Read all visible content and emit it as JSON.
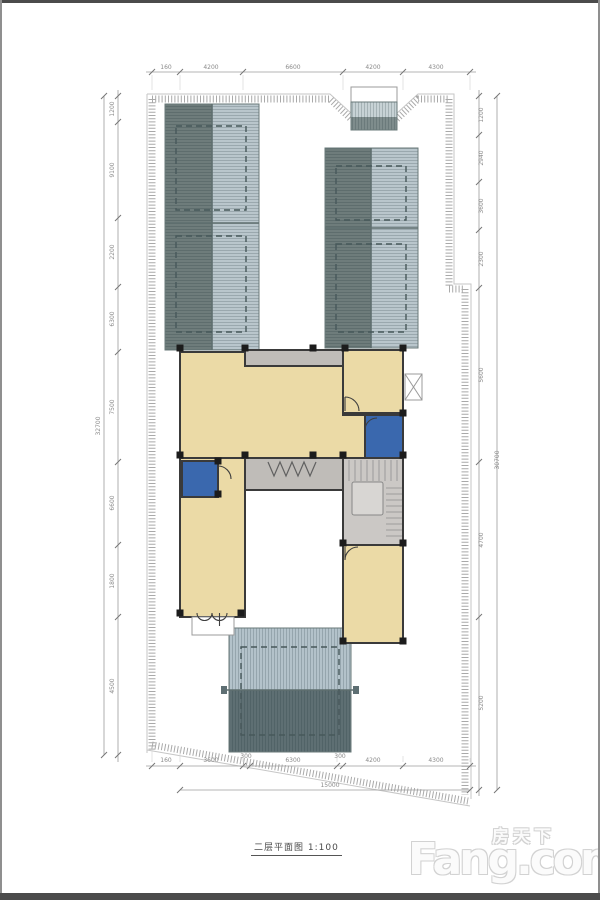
{
  "caption": "二层平面图 1:100",
  "watermark": {
    "brand_cn": "房天下",
    "brand_en": "Fang.com"
  },
  "colors": {
    "room": "#EBDAA6",
    "wet": "#3A68AE",
    "corridor": "#BFBCB8",
    "stair": "#CBC8C5",
    "landing": "#D8D6D3",
    "roof_dark": "#6E7C7B",
    "roof_light": "#B9C6CC",
    "roof_bottom_dark": "#5E6F73",
    "roof_bottom_light": "#B3C2CA",
    "canopy_light": "#C7D2D5",
    "canopy_dark": "#7E8C8C"
  },
  "dims": {
    "top": {
      "labels": [
        "160",
        "4200",
        "6600",
        "4200",
        "4300"
      ]
    },
    "bottom": {
      "labels": [
        "160",
        "3600",
        "300",
        "6300",
        "300",
        "4200",
        "4300"
      ],
      "total": "15000"
    },
    "left": {
      "labels": [
        "1200",
        "9100",
        "2200",
        "6300",
        "7500",
        "6600",
        "1800",
        "4500"
      ],
      "total": "32700"
    },
    "right": {
      "labels": [
        "1200",
        "2940",
        "3600",
        "2300",
        "5600",
        "4700",
        "5200"
      ],
      "total": "30700"
    }
  }
}
